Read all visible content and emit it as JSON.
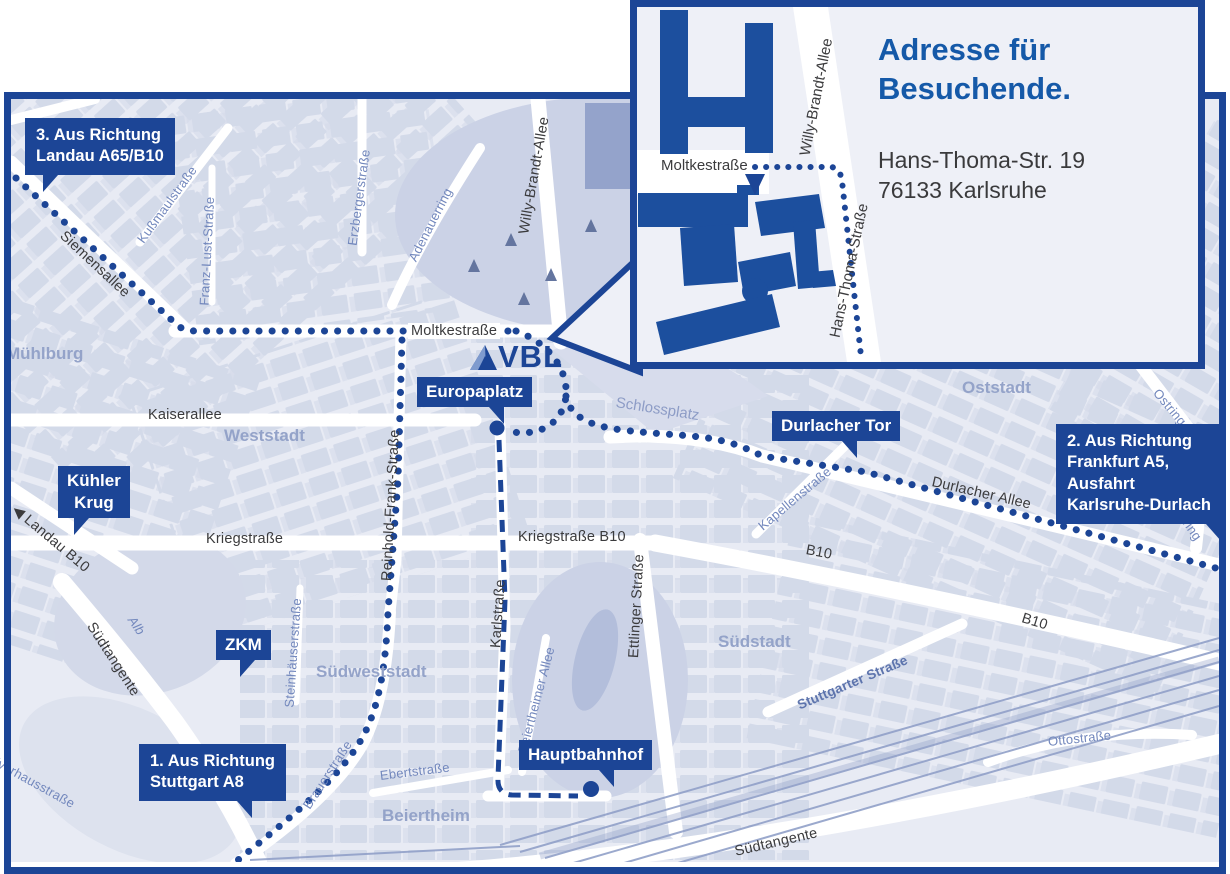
{
  "logo": {
    "text": "VBL"
  },
  "inset": {
    "title_line1": "Adresse für",
    "title_line2": "Besuchende.",
    "address_line1": "Hans-Thoma-Str. 19",
    "address_line2": "76133 Karlsruhe",
    "street_moltkestrasse": "Moltkestraße",
    "street_willy_brandt": "Willy-Brandt-Allee",
    "street_hans_thoma": "Hans-Thoma-Straße"
  },
  "callouts": {
    "route3_line1": "3. Aus Richtung",
    "route3_line2": "Landau A65/B10",
    "route2_line1": "2. Aus Richtung",
    "route2_line2": "Frankfurt A5,",
    "route2_line3": "Ausfahrt",
    "route2_line4": "Karlsruhe-Durlach",
    "route1_line1": "1. Aus Richtung",
    "route1_line2": "Stuttgart A8",
    "kuehler_krug_line1": "Kühler",
    "kuehler_krug_line2": "Krug",
    "zkm": "ZKM",
    "europaplatz": "Europaplatz",
    "durlacher_tor": "Durlacher Tor",
    "hauptbahnhof": "Hauptbahnhof"
  },
  "streets": {
    "kaiserallee": "Kaiserallee",
    "moltkestrasse": "Moltkestraße",
    "kriegstrasse": "Kriegstraße",
    "kriegstrasse_b10": "Kriegstraße B10",
    "karlstrasse": "Karlstraße",
    "ettlinger_strasse": "Ettlinger Straße",
    "willy_brandt_allee": "Willy-Brandt-Allee",
    "durlacher_allee": "Durlacher Allee",
    "b10_a": "B10",
    "b10_b": "B10",
    "siemensallee": "Siemensallee",
    "landau_b10": "Landau B10",
    "arrow_west": "◀",
    "suedtangente_w": "Südtangente",
    "suedtangente_s": "Südtangente",
    "reinhold_frank": "Reinhold-Frank-Straße",
    "brauerstrasse": "Brauerstraße",
    "ebertstrasse": "Ebertstraße",
    "steinhaeuserstrasse": "Steinhäuserstraße",
    "kapellenstrasse": "Kapellenstraße",
    "kussmaulstrasse": "Kußmaulstraße",
    "franz_lust": "Franz-Lust-Straße",
    "erzbergerstrasse": "Erzbergerstraße",
    "adenauerring": "Adenauerring",
    "ostring_a": "Ostring",
    "ostring_b": "Ostring",
    "ottostrasse": "Ottostraße",
    "stuttgarter_strasse": "Stuttgarter Straße",
    "beiertheimer_allee": "Beiertheimer Allee",
    "pulverhausstrasse": "Pulverhausstraße",
    "schlossplatz": "Schlossplatz",
    "alb": "Alb"
  },
  "areas": {
    "muehlburg": "Mühlburg",
    "weststadt": "Weststadt",
    "oststadt": "Oststadt",
    "suedstadt": "Südstadt",
    "suedweststadt": "Südweststadt",
    "beiertheim": "Beiertheim"
  },
  "colors": {
    "brand_blue": "#1c4596",
    "title_blue": "#1559a8",
    "map_bg": "#e8ebf4",
    "city_block": "#cdd4e6",
    "park": "#cbd2e6",
    "street_label": "#3b3b3d",
    "minor_street_label": "#7388bd",
    "area_label": "#94a3c9",
    "address_text": "#3a3a3c",
    "road_white": "#ffffff"
  }
}
